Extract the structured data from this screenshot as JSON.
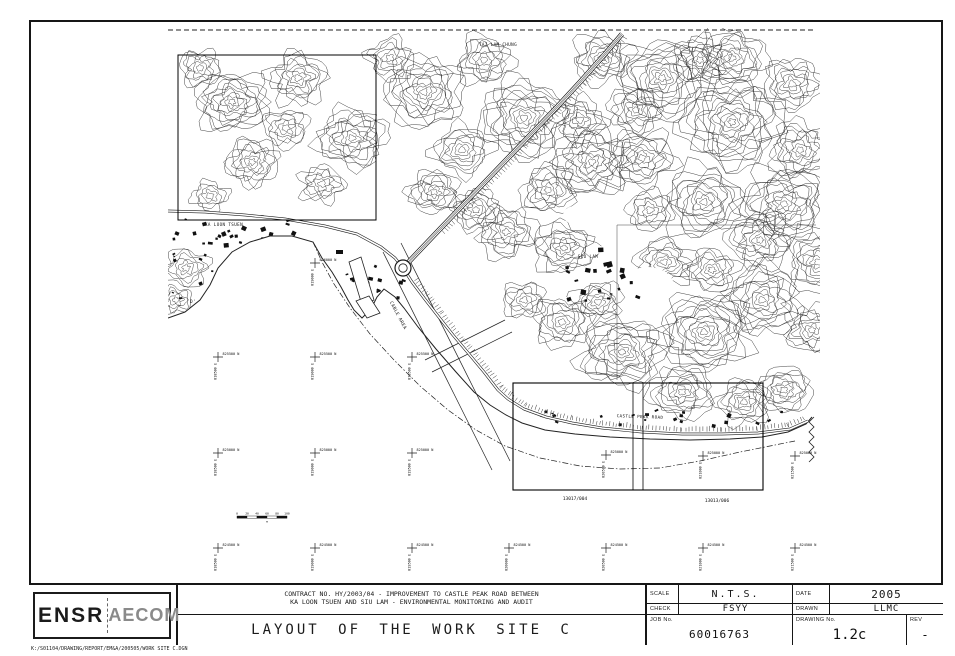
{
  "window": {
    "width": 955,
    "height": 656
  },
  "title_block": {
    "logo": {
      "ensr": "ENSR",
      "aecom": "AECOM"
    },
    "contract_line1": "CONTRACT NO. HY/2003/04 - IMPROVEMENT TO CASTLE PEAK ROAD BETWEEN",
    "contract_line2": "KA LOON TSUEN AND SIU LAM - ENVIRONMENTAL MONITORING AND AUDIT",
    "drawing_title": "LAYOUT OF THE WORK SITE C",
    "scale_label": "SCALE",
    "scale_value": "N.T.S.",
    "date_label": "DATE",
    "date_value": "2005",
    "check_label": "CHECK",
    "check_value": "FSYY",
    "drawn_label": "DRAWN",
    "drawn_value": "LLMC",
    "job_label": "JOB No.",
    "job_value": "60016763",
    "drawing_no_label": "DRAWING No.",
    "drawing_no_value": "1.2c",
    "rev_label": "REV",
    "rev_value": "-"
  },
  "footer_path": "K:/S01104/DRAWING/REPORT/EM&A/200505/WORK SITE C.DGN",
  "colors": {
    "ink": "#1a1a1a",
    "contour": "#2e2e2e",
    "paper": "#ffffff"
  },
  "map": {
    "place_labels": [
      {
        "text": "TAI LAM CHUNG",
        "x": 498,
        "y": 46,
        "r": 0
      },
      {
        "text": "KA LOON TSUEN",
        "x": 224,
        "y": 226,
        "r": 0
      },
      {
        "text": "SIU LAM",
        "x": 588,
        "y": 258,
        "r": 0
      },
      {
        "text": "CASTLE PEAK ROAD",
        "x": 640,
        "y": 418,
        "r": 2
      },
      {
        "text": "CABLE AREA",
        "x": 397,
        "y": 316,
        "r": 62
      },
      {
        "text": "D'",
        "x": 193,
        "y": 303,
        "r": 0
      }
    ],
    "lot_labels": [
      {
        "text": "13017/004",
        "x": 575,
        "y": 500
      },
      {
        "text": "13013/006",
        "x": 717,
        "y": 502
      }
    ],
    "grid_crosses": [
      {
        "x": 315,
        "y": 263,
        "n": "826000 N",
        "e": "819000 E"
      },
      {
        "x": 218,
        "y": 357,
        "n": "825500 N",
        "e": "818500 E"
      },
      {
        "x": 315,
        "y": 357,
        "n": "825500 N",
        "e": "819000 E"
      },
      {
        "x": 412,
        "y": 357,
        "n": "825500 N",
        "e": "819500 E"
      },
      {
        "x": 218,
        "y": 453,
        "n": "825000 N",
        "e": "818500 E"
      },
      {
        "x": 315,
        "y": 453,
        "n": "825000 N",
        "e": "819000 E"
      },
      {
        "x": 412,
        "y": 453,
        "n": "825000 N",
        "e": "819500 E"
      },
      {
        "x": 606,
        "y": 455,
        "n": "825000 N",
        "e": "820500 E"
      },
      {
        "x": 703,
        "y": 456,
        "n": "825000 N",
        "e": "821000 E"
      },
      {
        "x": 795,
        "y": 456,
        "n": "825000 N",
        "e": "821500 E"
      },
      {
        "x": 218,
        "y": 548,
        "n": "824500 N",
        "e": "818500 E"
      },
      {
        "x": 315,
        "y": 548,
        "n": "824500 N",
        "e": "819000 E"
      },
      {
        "x": 412,
        "y": 548,
        "n": "824500 N",
        "e": "819500 E"
      },
      {
        "x": 509,
        "y": 548,
        "n": "824500 N",
        "e": "820000 E"
      },
      {
        "x": 606,
        "y": 548,
        "n": "824500 N",
        "e": "820500 E"
      },
      {
        "x": 703,
        "y": 548,
        "n": "824500 N",
        "e": "821000 E"
      },
      {
        "x": 795,
        "y": 548,
        "n": "824500 N",
        "e": "821500 E"
      }
    ],
    "scale_bar": {
      "x": 237,
      "y": 516,
      "ticks": [
        "0",
        "20",
        "40",
        "60",
        "80",
        "100"
      ],
      "unit": "m"
    }
  }
}
